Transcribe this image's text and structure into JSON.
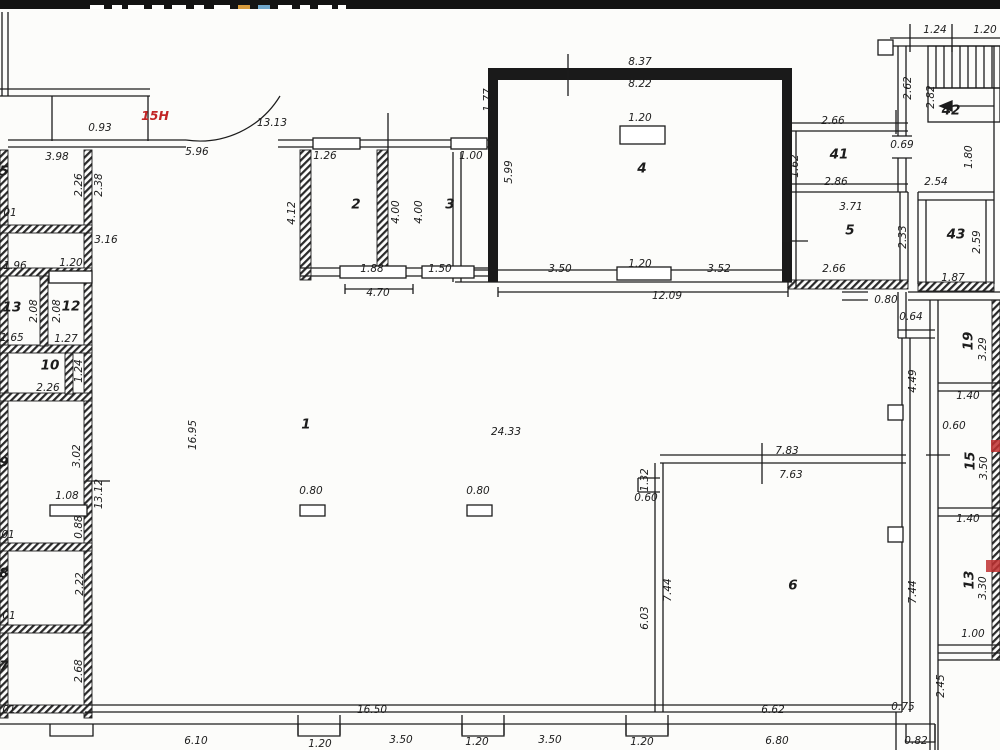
{
  "drawing": {
    "type": "floor-plan",
    "paper_color": "#fcfcfa",
    "line_color": "#1c1c1c",
    "red_color": "#c22525",
    "unit_label": "15H"
  },
  "title_bar": {
    "bg": "#131313",
    "fragments": [
      {
        "x": 90,
        "w": 14,
        "c": "#ffffff"
      },
      {
        "x": 112,
        "w": 10,
        "c": "#ffffff"
      },
      {
        "x": 128,
        "w": 16,
        "c": "#ffffff"
      },
      {
        "x": 152,
        "w": 12,
        "c": "#ffffff"
      },
      {
        "x": 172,
        "w": 14,
        "c": "#ffffff"
      },
      {
        "x": 194,
        "w": 10,
        "c": "#ffffff"
      },
      {
        "x": 214,
        "w": 16,
        "c": "#ffffff"
      },
      {
        "x": 238,
        "w": 12,
        "c": "#d79b3c"
      },
      {
        "x": 258,
        "w": 12,
        "c": "#6fa7cc"
      },
      {
        "x": 278,
        "w": 14,
        "c": "#ffffff"
      },
      {
        "x": 300,
        "w": 10,
        "c": "#ffffff"
      },
      {
        "x": 318,
        "w": 14,
        "c": "#ffffff"
      },
      {
        "x": 338,
        "w": 8,
        "c": "#ffffff"
      }
    ]
  },
  "plan": {
    "labels": [
      {
        "t": "15H",
        "x": 155,
        "y": 116,
        "k": "red"
      },
      {
        "t": "0.93",
        "x": 100,
        "y": 128,
        "k": "dim"
      },
      {
        "t": "13.13",
        "x": 272,
        "y": 123,
        "k": "dim"
      },
      {
        "t": "5.96",
        "x": 197,
        "y": 152,
        "k": "dim"
      },
      {
        "t": "3.98",
        "x": 57,
        "y": 157,
        "k": "dim"
      },
      {
        "t": "5",
        "x": 4,
        "y": 172,
        "k": "room"
      },
      {
        "t": "2.26",
        "x": 79,
        "y": 185,
        "k": "dim",
        "r": 1
      },
      {
        "t": "2.38",
        "x": 99,
        "y": 185,
        "k": "dim",
        "r": 1
      },
      {
        "t": "01",
        "x": 10,
        "y": 213,
        "k": "dim"
      },
      {
        "t": "3.16",
        "x": 106,
        "y": 240,
        "k": "dim"
      },
      {
        "t": "1.96",
        "x": 15,
        "y": 266,
        "k": "dim"
      },
      {
        "t": "1.20",
        "x": 71,
        "y": 263,
        "k": "dim"
      },
      {
        "t": "13",
        "x": 12,
        "y": 308,
        "k": "room"
      },
      {
        "t": "2.08",
        "x": 34,
        "y": 311,
        "k": "dim",
        "r": 1
      },
      {
        "t": "2.08",
        "x": 57,
        "y": 311,
        "k": "dim",
        "r": 1
      },
      {
        "t": "12",
        "x": 71,
        "y": 307,
        "k": "room"
      },
      {
        "t": "1.65",
        "x": 12,
        "y": 338,
        "k": "dim"
      },
      {
        "t": "1.27",
        "x": 66,
        "y": 339,
        "k": "dim"
      },
      {
        "t": "10",
        "x": 50,
        "y": 366,
        "k": "room"
      },
      {
        "t": "2.26",
        "x": 48,
        "y": 388,
        "k": "dim"
      },
      {
        "t": "1.24",
        "x": 79,
        "y": 371,
        "k": "dim",
        "r": 1
      },
      {
        "t": "9",
        "x": 4,
        "y": 463,
        "k": "room"
      },
      {
        "t": "3.02",
        "x": 77,
        "y": 456,
        "k": "dim",
        "r": 1
      },
      {
        "t": "13.12",
        "x": 99,
        "y": 494,
        "k": "dim",
        "r": 1
      },
      {
        "t": "1.08",
        "x": 67,
        "y": 496,
        "k": "dim"
      },
      {
        "t": "0.88",
        "x": 79,
        "y": 527,
        "k": "dim",
        "r": 1
      },
      {
        "t": "01",
        "x": 8,
        "y": 535,
        "k": "dim"
      },
      {
        "t": "8",
        "x": 4,
        "y": 574,
        "k": "room"
      },
      {
        "t": "2.22",
        "x": 80,
        "y": 584,
        "k": "dim",
        "r": 1
      },
      {
        "t": "01",
        "x": 9,
        "y": 616,
        "k": "dim"
      },
      {
        "t": "7",
        "x": 4,
        "y": 667,
        "k": "room"
      },
      {
        "t": "2.68",
        "x": 79,
        "y": 671,
        "k": "dim",
        "r": 1
      },
      {
        "t": "01",
        "x": 9,
        "y": 710,
        "k": "dim"
      },
      {
        "t": "16.95",
        "x": 193,
        "y": 435,
        "k": "dim",
        "r": 1
      },
      {
        "t": "1",
        "x": 306,
        "y": 425,
        "k": "room"
      },
      {
        "t": "24.33",
        "x": 506,
        "y": 432,
        "k": "dim"
      },
      {
        "t": "0.80",
        "x": 311,
        "y": 491,
        "k": "dim"
      },
      {
        "t": "0.80",
        "x": 478,
        "y": 491,
        "k": "dim"
      },
      {
        "t": "1.26",
        "x": 325,
        "y": 156,
        "k": "dim"
      },
      {
        "t": "2",
        "x": 356,
        "y": 205,
        "k": "room"
      },
      {
        "t": "4.12",
        "x": 292,
        "y": 213,
        "k": "dim",
        "r": 1
      },
      {
        "t": "4.00",
        "x": 396,
        "y": 212,
        "k": "dim",
        "r": 1
      },
      {
        "t": "4.00",
        "x": 419,
        "y": 212,
        "k": "dim",
        "r": 1
      },
      {
        "t": "3",
        "x": 450,
        "y": 205,
        "k": "room"
      },
      {
        "t": "1.00",
        "x": 471,
        "y": 156,
        "k": "dim"
      },
      {
        "t": "1.88",
        "x": 372,
        "y": 269,
        "k": "dim"
      },
      {
        "t": "1.50",
        "x": 440,
        "y": 269,
        "k": "dim"
      },
      {
        "t": "4.70",
        "x": 378,
        "y": 293,
        "k": "dim"
      },
      {
        "t": "1.77",
        "x": 488,
        "y": 100,
        "k": "dim",
        "r": 1
      },
      {
        "t": "5.99",
        "x": 509,
        "y": 172,
        "k": "dim",
        "r": 1
      },
      {
        "t": "8.37",
        "x": 640,
        "y": 62,
        "k": "dim"
      },
      {
        "t": "8.22",
        "x": 640,
        "y": 84,
        "k": "dim"
      },
      {
        "t": "1.20",
        "x": 640,
        "y": 118,
        "k": "dim"
      },
      {
        "t": "4",
        "x": 642,
        "y": 169,
        "k": "room"
      },
      {
        "t": "3.50",
        "x": 560,
        "y": 269,
        "k": "dim"
      },
      {
        "t": "1.20",
        "x": 640,
        "y": 264,
        "k": "dim"
      },
      {
        "t": "3.52",
        "x": 719,
        "y": 269,
        "k": "dim"
      },
      {
        "t": "12.09",
        "x": 667,
        "y": 296,
        "k": "dim"
      },
      {
        "t": "2.62",
        "x": 908,
        "y": 88,
        "k": "dim",
        "r": 1
      },
      {
        "t": "2.82",
        "x": 931,
        "y": 97,
        "k": "dim",
        "r": 1
      },
      {
        "t": "42",
        "x": 951,
        "y": 111,
        "k": "room"
      },
      {
        "t": "1.24",
        "x": 935,
        "y": 30,
        "k": "dim"
      },
      {
        "t": "1.20",
        "x": 985,
        "y": 30,
        "k": "dim"
      },
      {
        "t": "2.66",
        "x": 833,
        "y": 121,
        "k": "dim"
      },
      {
        "t": "41",
        "x": 839,
        "y": 155,
        "k": "room"
      },
      {
        "t": "1.62",
        "x": 795,
        "y": 166,
        "k": "dim",
        "r": 1
      },
      {
        "t": "2.86",
        "x": 836,
        "y": 182,
        "k": "dim"
      },
      {
        "t": "0.69",
        "x": 902,
        "y": 145,
        "k": "dim"
      },
      {
        "t": "1.80",
        "x": 969,
        "y": 157,
        "k": "dim",
        "r": 1
      },
      {
        "t": "2.54",
        "x": 936,
        "y": 182,
        "k": "dim"
      },
      {
        "t": "3.71",
        "x": 851,
        "y": 207,
        "k": "dim"
      },
      {
        "t": "5",
        "x": 850,
        "y": 231,
        "k": "room"
      },
      {
        "t": "2.33",
        "x": 903,
        "y": 237,
        "k": "dim",
        "r": 1
      },
      {
        "t": "43",
        "x": 956,
        "y": 235,
        "k": "room"
      },
      {
        "t": "2.59",
        "x": 977,
        "y": 242,
        "k": "dim",
        "r": 1
      },
      {
        "t": "1.87",
        "x": 953,
        "y": 278,
        "k": "dim"
      },
      {
        "t": "2.66",
        "x": 834,
        "y": 269,
        "k": "dim"
      },
      {
        "t": "0.80",
        "x": 886,
        "y": 300,
        "k": "dim"
      },
      {
        "t": "0.64",
        "x": 911,
        "y": 317,
        "k": "dim"
      },
      {
        "t": "4.49",
        "x": 913,
        "y": 381,
        "k": "dim",
        "r": 1
      },
      {
        "t": "19",
        "x": 969,
        "y": 341,
        "k": "room",
        "r": 1
      },
      {
        "t": "3.29",
        "x": 983,
        "y": 349,
        "k": "dim",
        "r": 1
      },
      {
        "t": "1.40",
        "x": 968,
        "y": 396,
        "k": "dim"
      },
      {
        "t": "0.60",
        "x": 954,
        "y": 426,
        "k": "dim"
      },
      {
        "t": "15",
        "x": 971,
        "y": 461,
        "k": "room",
        "r": 1
      },
      {
        "t": "3.50",
        "x": 984,
        "y": 468,
        "k": "dim",
        "r": 1
      },
      {
        "t": "1.40",
        "x": 968,
        "y": 519,
        "k": "dim"
      },
      {
        "t": "13",
        "x": 970,
        "y": 580,
        "k": "room",
        "r": 1
      },
      {
        "t": "3.30",
        "x": 983,
        "y": 588,
        "k": "dim",
        "r": 1
      },
      {
        "t": "1.00",
        "x": 973,
        "y": 634,
        "k": "dim"
      },
      {
        "t": "7.83",
        "x": 787,
        "y": 451,
        "k": "dim"
      },
      {
        "t": "7.63",
        "x": 791,
        "y": 475,
        "k": "dim"
      },
      {
        "t": "1.32",
        "x": 645,
        "y": 480,
        "k": "dim",
        "r": 1
      },
      {
        "t": "0.60",
        "x": 646,
        "y": 498,
        "k": "dim"
      },
      {
        "t": "6",
        "x": 793,
        "y": 586,
        "k": "room"
      },
      {
        "t": "7.44",
        "x": 668,
        "y": 590,
        "k": "dim",
        "r": 1
      },
      {
        "t": "6.03",
        "x": 645,
        "y": 618,
        "k": "dim",
        "r": 1
      },
      {
        "t": "7.44",
        "x": 913,
        "y": 592,
        "k": "dim",
        "r": 1
      },
      {
        "t": "6.62",
        "x": 773,
        "y": 710,
        "k": "dim"
      },
      {
        "t": "0.75",
        "x": 903,
        "y": 707,
        "k": "dim"
      },
      {
        "t": "2.45",
        "x": 941,
        "y": 686,
        "k": "dim",
        "r": 1
      },
      {
        "t": "16.50",
        "x": 372,
        "y": 710,
        "k": "dim"
      },
      {
        "t": "6.10",
        "x": 196,
        "y": 741,
        "k": "dim"
      },
      {
        "t": "1.20",
        "x": 320,
        "y": 744,
        "k": "dim"
      },
      {
        "t": "3.50",
        "x": 401,
        "y": 740,
        "k": "dim"
      },
      {
        "t": "1.20",
        "x": 477,
        "y": 742,
        "k": "dim"
      },
      {
        "t": "3.50",
        "x": 550,
        "y": 740,
        "k": "dim"
      },
      {
        "t": "1.20",
        "x": 642,
        "y": 742,
        "k": "dim"
      },
      {
        "t": "6.80",
        "x": 777,
        "y": 741,
        "k": "dim"
      },
      {
        "t": "0.82",
        "x": 916,
        "y": 741,
        "k": "dim"
      }
    ]
  }
}
